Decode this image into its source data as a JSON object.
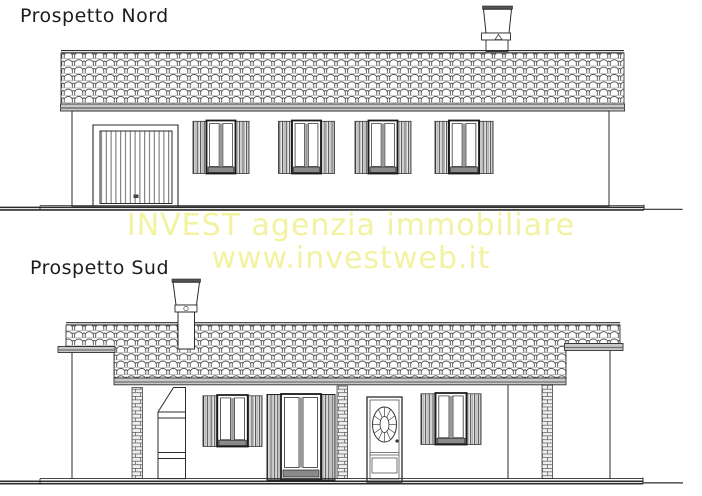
{
  "document": {
    "kind": "architectural-elevations-drawing",
    "background": "#ffffff",
    "line_color": "#2b2b2b",
    "fascia_color": "#c9c9c9"
  },
  "watermark": {
    "line1": "INVEST agenzia immobiliare",
    "line2": "www.investweb.it",
    "color": "#f2f2a0"
  },
  "elevations": {
    "north": {
      "title": "Prospetto Nord"
    },
    "south": {
      "title": "Prospetto Sud"
    }
  }
}
